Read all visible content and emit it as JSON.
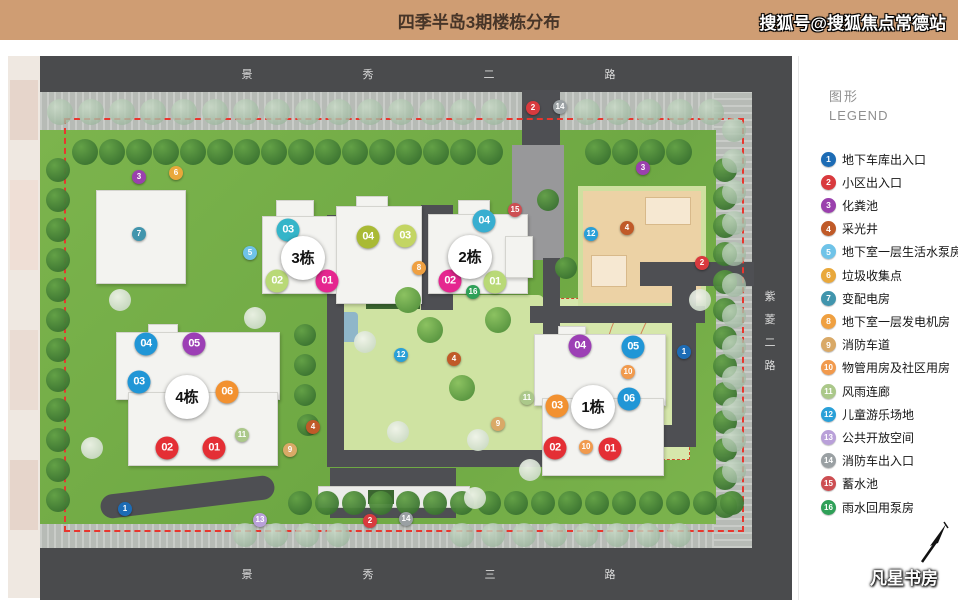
{
  "header": {
    "title": "四季半岛3期楼栋分布",
    "watermark": "搜狐号@搜狐焦点常德站",
    "bg_color": "#cf9d73"
  },
  "legend": {
    "title_cn": "图形",
    "title_en": "LEGEND",
    "items": [
      {
        "num": "1",
        "label": "地下车库出入口",
        "color": "#1d6cb5"
      },
      {
        "num": "2",
        "label": "小区出入口",
        "color": "#d93a3e"
      },
      {
        "num": "3",
        "label": "化粪池",
        "color": "#9a40ad"
      },
      {
        "num": "4",
        "label": "采光井",
        "color": "#c05a28"
      },
      {
        "num": "5",
        "label": "地下室一层生活水泵房",
        "color": "#6fc3e8"
      },
      {
        "num": "6",
        "label": "垃圾收集点",
        "color": "#e9a83b"
      },
      {
        "num": "7",
        "label": "变配电房",
        "color": "#4195ad"
      },
      {
        "num": "8",
        "label": "地下室一层发电机房",
        "color": "#efa041"
      },
      {
        "num": "9",
        "label": "消防车道",
        "color": "#d9a967"
      },
      {
        "num": "10",
        "label": "物管用房及社区用房",
        "color": "#f19a4d"
      },
      {
        "num": "11",
        "label": "风雨连廊",
        "color": "#abc88a"
      },
      {
        "num": "12",
        "label": "儿童游乐场地",
        "color": "#2aa0d8"
      },
      {
        "num": "13",
        "label": "公共开放空间",
        "color": "#b9a0d9"
      },
      {
        "num": "14",
        "label": "消防车出入口",
        "color": "#9aa0a3"
      },
      {
        "num": "15",
        "label": "蓄水池",
        "color": "#cd4e52"
      },
      {
        "num": "16",
        "label": "雨水回用泵房",
        "color": "#2fa058"
      }
    ]
  },
  "roads": {
    "top": "景秀二路",
    "bottom": "景秀三路",
    "right": "紫菱二路"
  },
  "map": {
    "buildings": [
      {
        "label": "1栋",
        "x": 593,
        "y": 407
      },
      {
        "label": "2栋",
        "x": 470,
        "y": 257
      },
      {
        "label": "3栋",
        "x": 303,
        "y": 258
      },
      {
        "label": "4栋",
        "x": 187,
        "y": 397
      }
    ],
    "unit_badges": [
      {
        "b": "3",
        "u": "03",
        "x": 288,
        "y": 230,
        "color": "#35b5c9"
      },
      {
        "b": "3",
        "u": "04",
        "x": 368,
        "y": 237,
        "color": "#a9ba35"
      },
      {
        "b": "3",
        "u": "02",
        "x": 277,
        "y": 281,
        "color": "#b9d977"
      },
      {
        "b": "3",
        "u": "01",
        "x": 327,
        "y": 281,
        "color": "#e5268f"
      },
      {
        "b": "2",
        "u": "03",
        "x": 405,
        "y": 236,
        "color": "#c3d563"
      },
      {
        "b": "2",
        "u": "04",
        "x": 484,
        "y": 221,
        "color": "#38aed0"
      },
      {
        "b": "2",
        "u": "02",
        "x": 450,
        "y": 281,
        "color": "#e5268f"
      },
      {
        "b": "2",
        "u": "01",
        "x": 495,
        "y": 282,
        "color": "#b9d977"
      },
      {
        "b": "4",
        "u": "04",
        "x": 146,
        "y": 344,
        "color": "#2196d6"
      },
      {
        "b": "4",
        "u": "05",
        "x": 194,
        "y": 344,
        "color": "#9c3fb5"
      },
      {
        "b": "4",
        "u": "03",
        "x": 139,
        "y": 382,
        "color": "#2196d6"
      },
      {
        "b": "4",
        "u": "06",
        "x": 227,
        "y": 392,
        "color": "#f29130"
      },
      {
        "b": "4",
        "u": "02",
        "x": 167,
        "y": 448,
        "color": "#e42f35"
      },
      {
        "b": "4",
        "u": "01",
        "x": 214,
        "y": 448,
        "color": "#e42f35"
      },
      {
        "b": "1",
        "u": "04",
        "x": 580,
        "y": 346,
        "color": "#9c3fb5"
      },
      {
        "b": "1",
        "u": "05",
        "x": 633,
        "y": 347,
        "color": "#2196d6"
      },
      {
        "b": "1",
        "u": "06",
        "x": 629,
        "y": 399,
        "color": "#2196d6"
      },
      {
        "b": "1",
        "u": "03",
        "x": 557,
        "y": 406,
        "color": "#f29130"
      },
      {
        "b": "1",
        "u": "02",
        "x": 555,
        "y": 448,
        "color": "#e42f35"
      },
      {
        "b": "1",
        "u": "01",
        "x": 610,
        "y": 449,
        "color": "#e42f35"
      }
    ],
    "markers": [
      {
        "n": 1,
        "x": 684,
        "y": 352
      },
      {
        "n": 1,
        "x": 125,
        "y": 509
      },
      {
        "n": 2,
        "x": 533,
        "y": 108
      },
      {
        "n": 2,
        "x": 702,
        "y": 263
      },
      {
        "n": 2,
        "x": 370,
        "y": 521
      },
      {
        "n": 3,
        "x": 139,
        "y": 177
      },
      {
        "n": 3,
        "x": 643,
        "y": 168
      },
      {
        "n": 4,
        "x": 627,
        "y": 228
      },
      {
        "n": 4,
        "x": 454,
        "y": 359
      },
      {
        "n": 4,
        "x": 313,
        "y": 427
      },
      {
        "n": 5,
        "x": 250,
        "y": 253
      },
      {
        "n": 6,
        "x": 176,
        "y": 173
      },
      {
        "n": 7,
        "x": 139,
        "y": 234
      },
      {
        "n": 8,
        "x": 419,
        "y": 268
      },
      {
        "n": 9,
        "x": 498,
        "y": 424
      },
      {
        "n": 9,
        "x": 290,
        "y": 450
      },
      {
        "n": 10,
        "x": 628,
        "y": 372
      },
      {
        "n": 10,
        "x": 586,
        "y": 447
      },
      {
        "n": 11,
        "x": 527,
        "y": 398
      },
      {
        "n": 11,
        "x": 242,
        "y": 435
      },
      {
        "n": 12,
        "x": 591,
        "y": 234
      },
      {
        "n": 12,
        "x": 401,
        "y": 355
      },
      {
        "n": 13,
        "x": 260,
        "y": 520
      },
      {
        "n": 14,
        "x": 560,
        "y": 107
      },
      {
        "n": 14,
        "x": 406,
        "y": 519
      },
      {
        "n": 15,
        "x": 515,
        "y": 210
      },
      {
        "n": 16,
        "x": 473,
        "y": 292
      }
    ]
  },
  "brand": {
    "name": "凡星书房"
  }
}
